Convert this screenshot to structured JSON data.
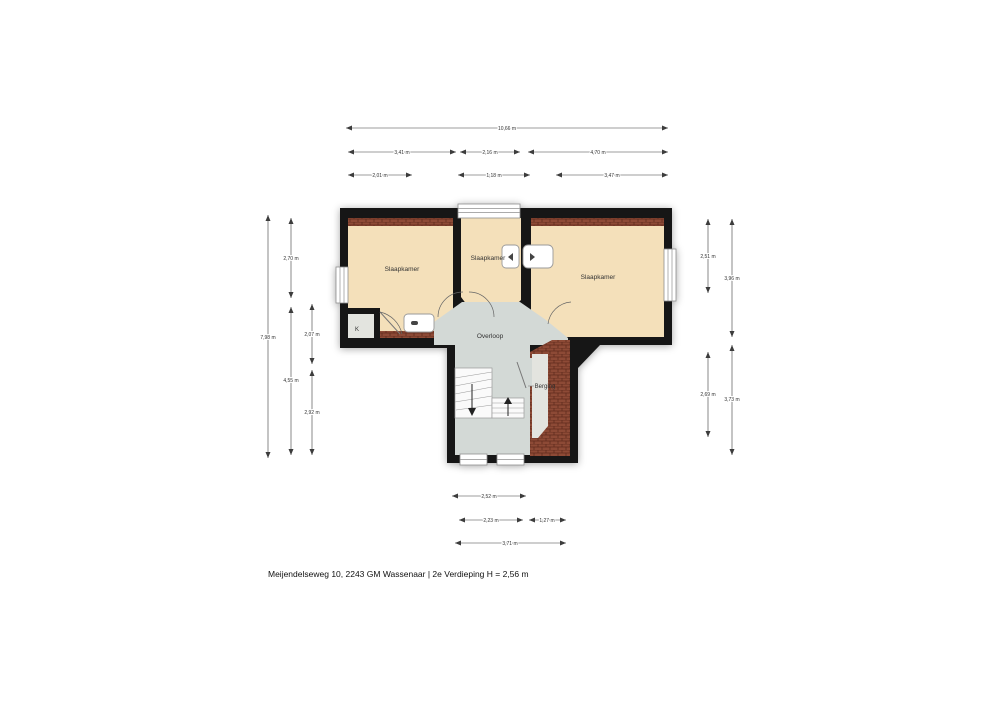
{
  "meta": {
    "caption": "Meijendelseweg 10, 2243 GM Wassenaar | 2e Verdieping H = 2,56 m"
  },
  "floorplan": {
    "rooms": {
      "bedroom_left": "Slaapkamer",
      "bedroom_middle": "Slaapkamer",
      "bedroom_right": "Slaapkamer",
      "landing": "Overloop",
      "storage": "Berging",
      "closet": "K"
    },
    "dimensions": {
      "top_total": "10,66 m",
      "top_r2_left": "3,41 m",
      "top_r2_mid": "2,16 m",
      "top_r2_right": "4,70 m",
      "top_r3_left": "2,01 m",
      "top_r3_mid": "1,18 m",
      "top_r3_right": "3,47 m",
      "left_total": "7,98 m",
      "left_upper": "2,70 m",
      "left_lower": "4,55 m",
      "left_inner_upper": "2,07 m",
      "left_inner_lower": "2,92 m",
      "right_inner_upper": "2,51 m",
      "right_inner_lower": "2,69 m",
      "right_outer_upper": "3,96 m",
      "right_outer_lower": "3,73 m",
      "bottom_r1": "2,52 m",
      "bottom_r2_left": "2,23 m",
      "bottom_r2_right": "1,27 m",
      "bottom_r3": "3,71 m"
    },
    "colors": {
      "wall": "#161616",
      "room": "#f4e0ba",
      "hall": "#d3d9d6",
      "storage": "#e3e4df",
      "brick": "#8d4a36",
      "brick_line": "#5e2a1b",
      "dim": "#3c3c3c",
      "frame": "#8f8f8f"
    }
  }
}
